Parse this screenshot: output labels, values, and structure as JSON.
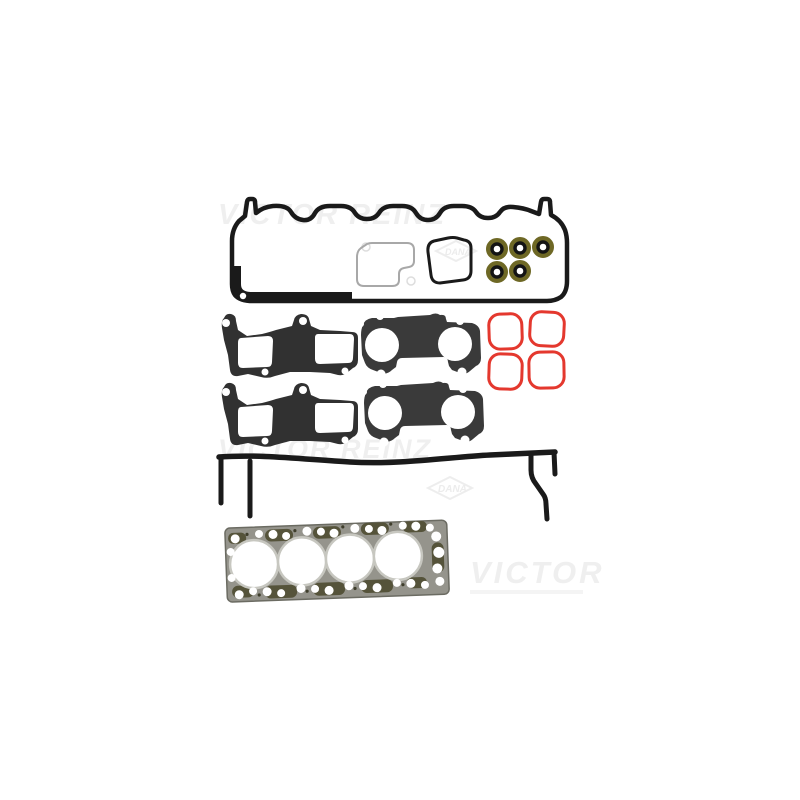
{
  "image": {
    "type": "product-photo",
    "subject": "Engine cylinder head gasket set (flat-lay on white background)",
    "brand": "VICTOR REINZ"
  },
  "watermarks": {
    "top": "VICTOR REINZ",
    "middle": "VICTOR REINZ",
    "bottom": "VICTOR",
    "logo": "DANA"
  },
  "colors": {
    "background": "#ffffff",
    "rubber_black": "#1a1a1a",
    "intake_dark": "#313131",
    "exhaust_gray": "#3a3a3a",
    "seal_olive": "#6e6825",
    "seal_red": "#e4382e",
    "head_base": "#95948c",
    "head_dark": "#55533a",
    "head_edge": "#6b6b62",
    "bore_ring": "#c7c7c0",
    "inner_gasket_gray": "#a8a8a8",
    "watermark_gray": "#efefef"
  },
  "parts": [
    {
      "name": "valve-cover-gasket",
      "count": 1,
      "color": "#1a1a1a"
    },
    {
      "name": "inner-cover-gasket-thin",
      "count": 1,
      "color": "#a8a8a8"
    },
    {
      "name": "inner-cover-gasket-bold",
      "count": 1,
      "color": "#1a1a1a"
    },
    {
      "name": "valve-stem-seal",
      "count": 5,
      "color": "#6e6825"
    },
    {
      "name": "intake-manifold-gasket",
      "count": 2,
      "color": "#313131"
    },
    {
      "name": "exhaust-manifold-gasket",
      "count": 2,
      "color": "#3a3a3a"
    },
    {
      "name": "round-port-seal-red",
      "count": 4,
      "color": "#e4382e"
    },
    {
      "name": "side-cover-gasket",
      "count": 1,
      "color": "#1a1a1a"
    },
    {
      "name": "cylinder-head-gasket",
      "count": 1,
      "color": "#95948c",
      "bores": 4
    }
  ]
}
